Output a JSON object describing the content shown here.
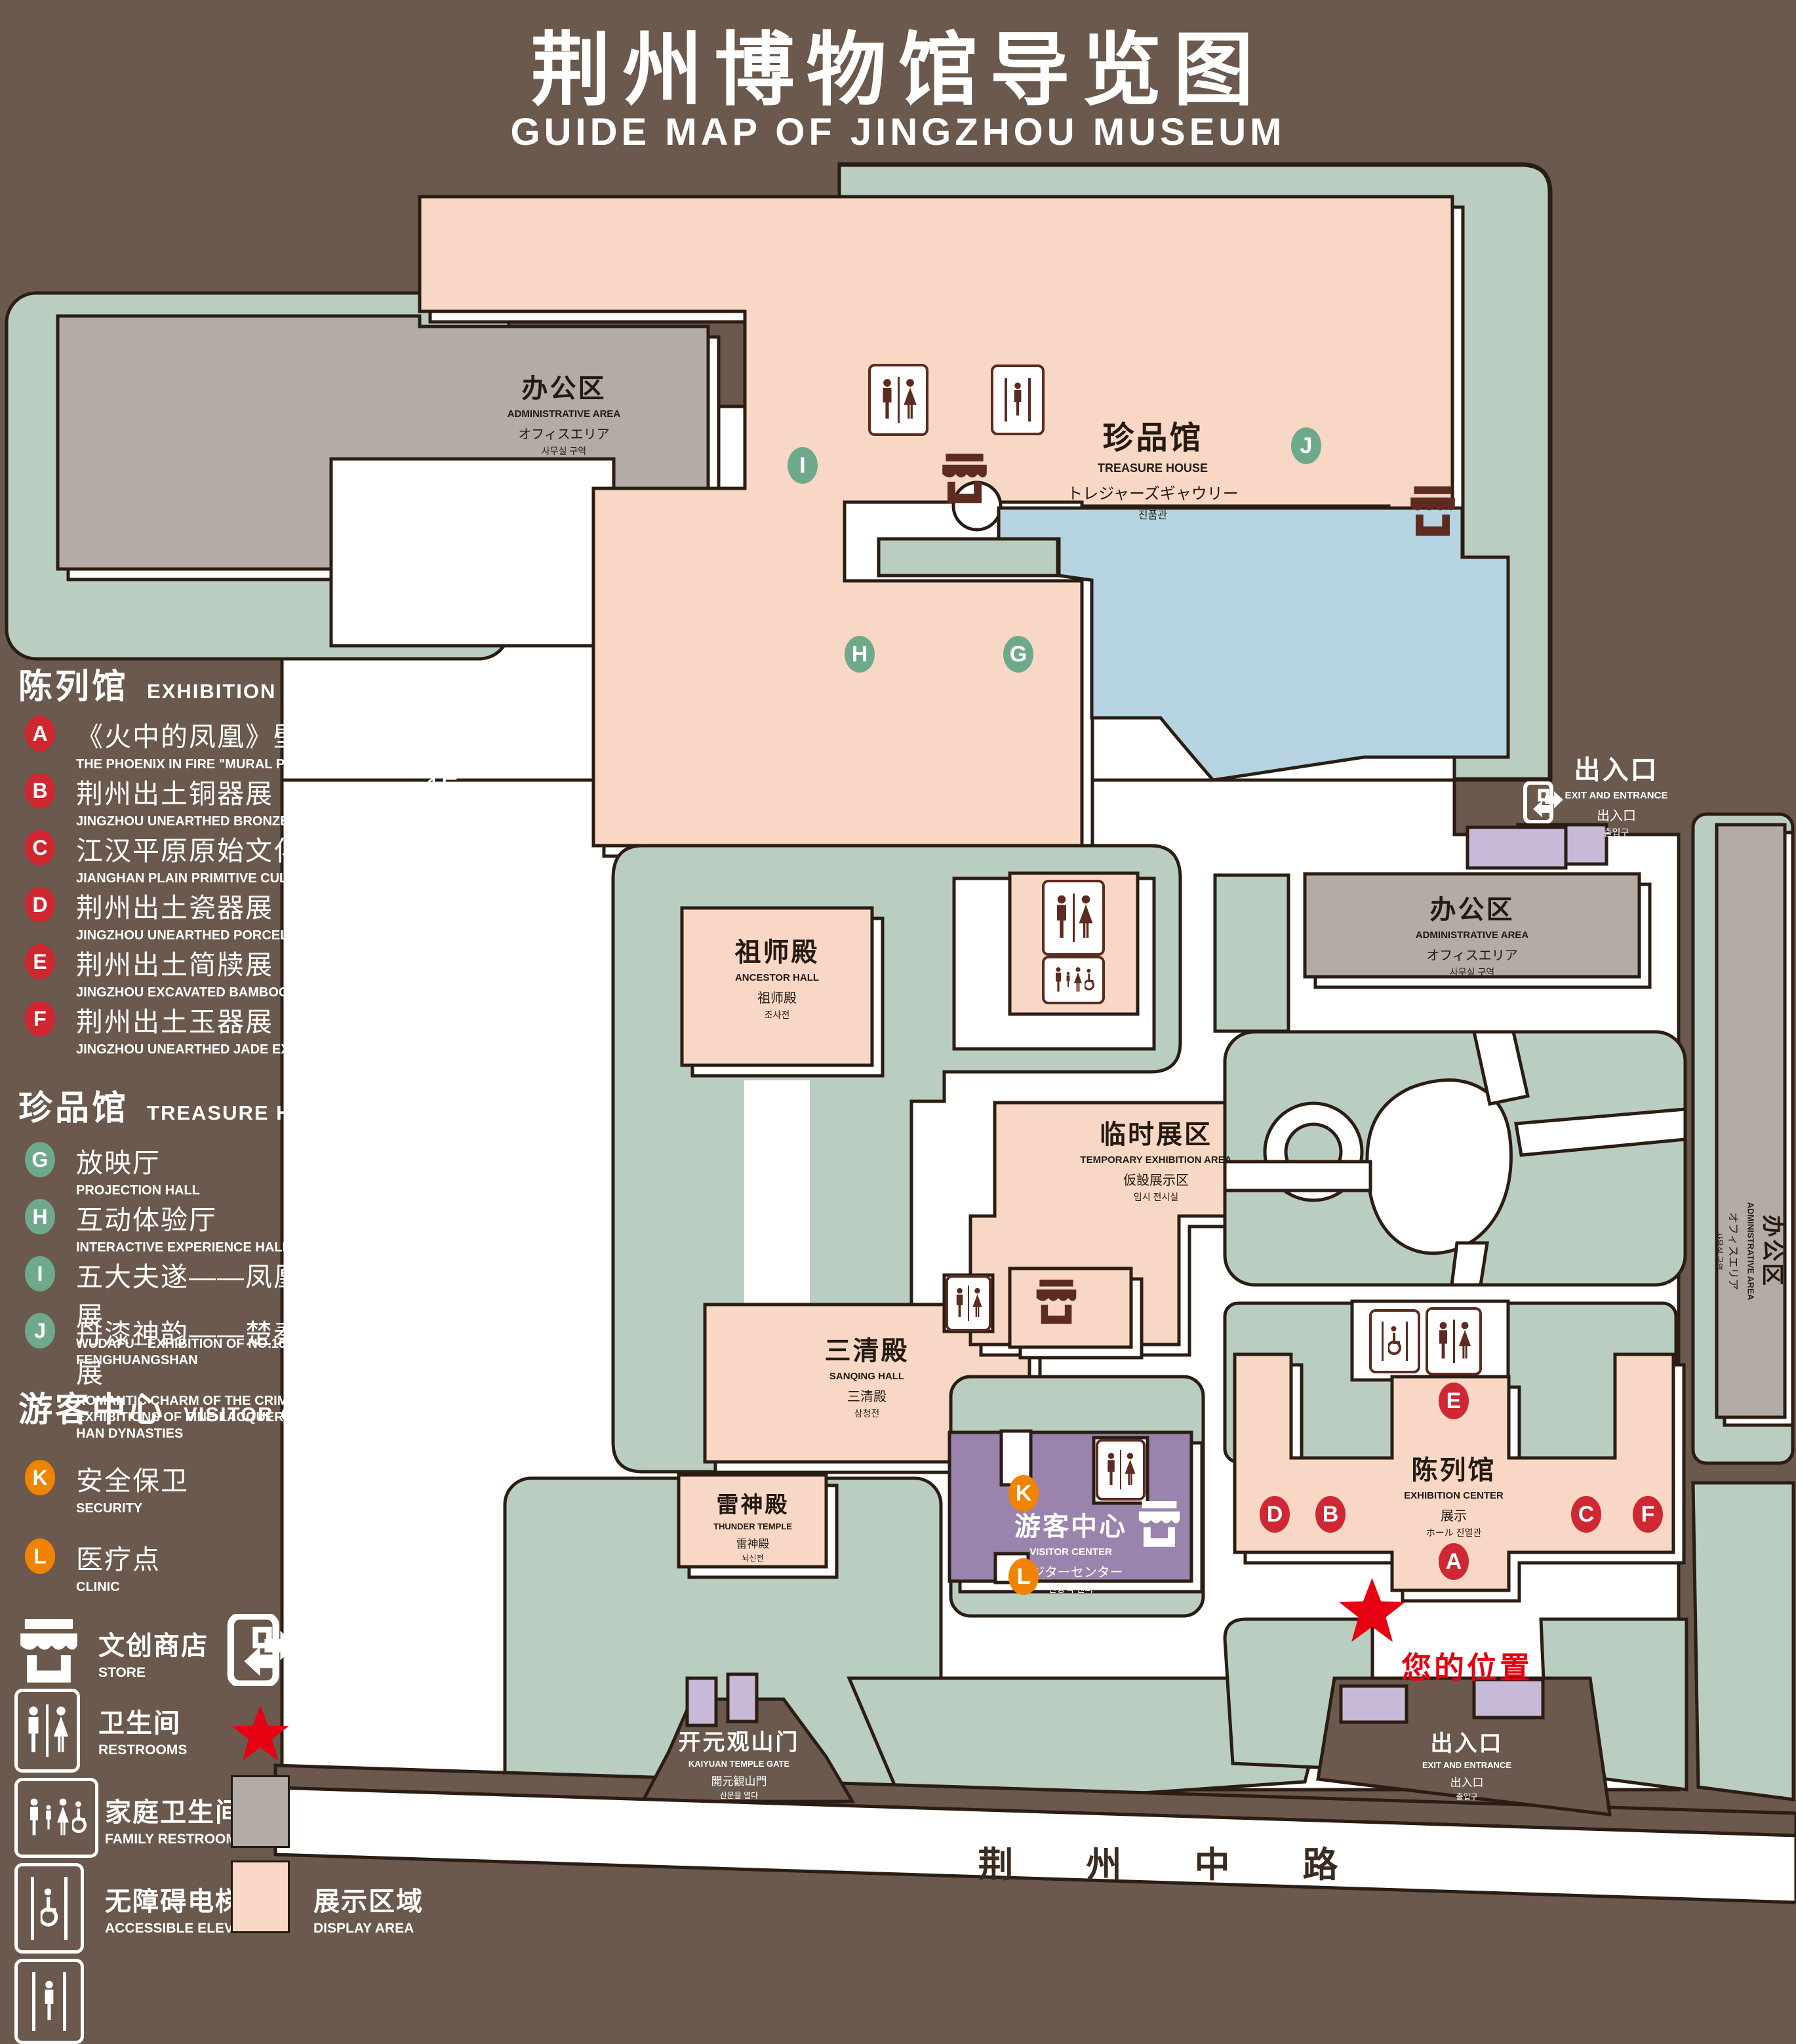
{
  "title": {
    "zh": "荆州博物馆导览图",
    "en": "GUIDE MAP OF JINGZHOU MUSEUM"
  },
  "colors": {
    "background": "#6a594c",
    "display_area": "#f8d8c5",
    "office_area": "#b2aba6",
    "green": "#b9cec0",
    "pond": "#b5d3e0",
    "visitor_center": "#9a84ae",
    "light_purple": "#c9b9d8",
    "marker_red": "#cf2734",
    "marker_green": "#6fa98c",
    "marker_orange": "#f08400",
    "star_red": "#e60012"
  },
  "legend": {
    "sections": [
      {
        "zh": "陈列馆",
        "en": "EXHIBITION CENTER",
        "items": [
          {
            "id": "A",
            "zh": "《火中的凤凰》壁画",
            "en": "THE PHOENIX IN FIRE \"MURAL PAINTING",
            "floor": "1F"
          },
          {
            "id": "B",
            "zh": "荆州出土铜器展",
            "en": "JINGZHOU UNEARTHED BRONZE WARE EXHIBITION",
            "floor": "1F"
          },
          {
            "id": "C",
            "zh": "江汉平原原始文化展",
            "en": "JIANGHAN PLAIN PRIMITIVE CULTURE EXHIBITION",
            "floor": "1F"
          },
          {
            "id": "D",
            "zh": "荆州出土瓷器展",
            "en": "JINGZHOU UNEARTHED PORCELAIN EXHIBITIONE",
            "floor": "2F"
          },
          {
            "id": "E",
            "zh": "荆州出土简牍展",
            "en": "JINGZHOU EXCAVATED BAMBOO SLIPS EXHIBITION",
            "floor": "2F"
          },
          {
            "id": "F",
            "zh": "荆州出土玉器展",
            "en": "JINGZHOU UNEARTHED JADE EXHIBITION",
            "floor": "2F"
          }
        ]
      },
      {
        "zh": "珍品馆",
        "en": "TREASURE HOUSE",
        "items": [
          {
            "id": "G",
            "zh": "放映厅",
            "en": "PROJECTION HALL",
            "floor": "1F"
          },
          {
            "id": "H",
            "zh": "互动体验厅",
            "en": "INTERACTIVE EXPERIENCE HALL",
            "floor": "1F"
          },
          {
            "id": "I",
            "zh": "五大夫遂——凤凰山168号汉墓展",
            "en": "WUDAFU—EXHIBITION OF NO.168 HAN TOMB FROM FENGHUANGSHAN",
            "floor": "2F"
          },
          {
            "id": "J",
            "zh": "丹漆神韵——楚秦汉漆器精品展",
            "en": "ROMANTIC CHARM OF THE CRIMSON LACQUERS—EXHIBITIONS OF FINE LACQUERS FROM CHU,QIN AND HAN DYNASTIES",
            "floor": "1-2F"
          }
        ]
      },
      {
        "zh": "游客中心",
        "en": "VISITOR CENTER",
        "items": [
          {
            "id": "K",
            "zh": "安全保卫",
            "en": "SECURITY",
            "floor": "1F"
          },
          {
            "id": "L",
            "zh": "医疗点",
            "en": "CLINIC",
            "floor": "1F"
          }
        ]
      }
    ],
    "symbols": [
      {
        "icon": "store-icon",
        "zh": "文创商店",
        "en": "STORE"
      },
      {
        "icon": "exit-icon",
        "zh": "出入口",
        "en": "EXIT AND ENTRANCE"
      },
      {
        "icon": "restrooms-icon",
        "zh": "卫生间",
        "en": "RESTROOMS"
      },
      {
        "icon": "your-location-star-icon",
        "zh": "您的位置",
        "en": "YOUR LOCATION"
      },
      {
        "icon": "family-restrooms-icon",
        "zh": "家庭卫生间",
        "en": "FAMILY RESTROOMS"
      },
      {
        "icon": "office-area-swatch",
        "zh": "办公区域",
        "en": "OFFICE AREA"
      },
      {
        "icon": "accessible-elevator-icon",
        "zh": "无障碍电梯",
        "en": "ACCESSIBLE ELEVATOR"
      },
      {
        "icon": "display-area-swatch",
        "zh": "展示区域",
        "en": "DISPLAY AREA"
      },
      {
        "icon": "elevator-icon",
        "zh": "电梯",
        "en": "Elevator"
      }
    ]
  },
  "map": {
    "buildings": {
      "admin_tl": {
        "zh": "办公区",
        "en": "ADMINISTRATIVE AREA",
        "l3": "オフィスエリア",
        "l4": "사무실 구역"
      },
      "treasure": {
        "zh": "珍品馆",
        "en": "TREASURE HOUSE",
        "l3": "トレジャーズギャウリー",
        "l4": "진품관"
      },
      "ancestor": {
        "zh": "祖师殿",
        "en": "ANCESTOR HALL",
        "l3": "祖师殿",
        "l4": "조사전"
      },
      "admin_right": {
        "zh": "办公区",
        "en": "ADMINISTRATIVE AREA",
        "l3": "オフィスエリア",
        "l4": "사무실 구역"
      },
      "temp_exhibit": {
        "zh": "临时展区",
        "en": "TEMPORARY EXHIBITION AREA",
        "l3": "仮設展示区",
        "l4": "임시 전시실"
      },
      "sanqing": {
        "zh": "三清殿",
        "en": "SANQING HALL",
        "l3": "三清殿",
        "l4": "삼청전"
      },
      "admin_far_right": {
        "zh": "办公区",
        "en": "ADMINISTRATIVE AREA",
        "l3": "オフィスエリア",
        "l4": "사무실 구역"
      },
      "thunder": {
        "zh": "雷神殿",
        "en": "THUNDER TEMPLE",
        "l3": "雷神殿",
        "l4": "뇌신전"
      },
      "visitor": {
        "zh": "游客中心",
        "en": "VISITOR CENTER",
        "l3": "ビジターセンター",
        "l4": "관광객 센터"
      },
      "exhibition": {
        "zh": "陈列馆",
        "en": "EXHIBITION CENTER",
        "l3": "展示",
        "l4": "ホール 진열관"
      },
      "exit_right": {
        "zh": "出入口",
        "en": "EXIT AND ENTRANCE",
        "l3": "出入口",
        "l4": "출입구"
      },
      "exit_bottom": {
        "zh": "出入口",
        "en": "EXIT AND ENTRANCE",
        "l3": "出入口",
        "l4": "출입구"
      },
      "gate": {
        "zh": "开元观山门",
        "en": "KAIYUAN TEMPLE GATE",
        "l3": "開元観山門",
        "l4": "산문을 열다"
      },
      "road": {
        "zh": "荆 州 中 路"
      },
      "your_location": {
        "zh": "您的位置"
      }
    },
    "markers": [
      {
        "id": "A"
      },
      {
        "id": "B"
      },
      {
        "id": "C"
      },
      {
        "id": "D"
      },
      {
        "id": "E"
      },
      {
        "id": "F"
      },
      {
        "id": "G"
      },
      {
        "id": "H"
      },
      {
        "id": "I"
      },
      {
        "id": "J"
      },
      {
        "id": "K"
      },
      {
        "id": "L"
      }
    ]
  }
}
